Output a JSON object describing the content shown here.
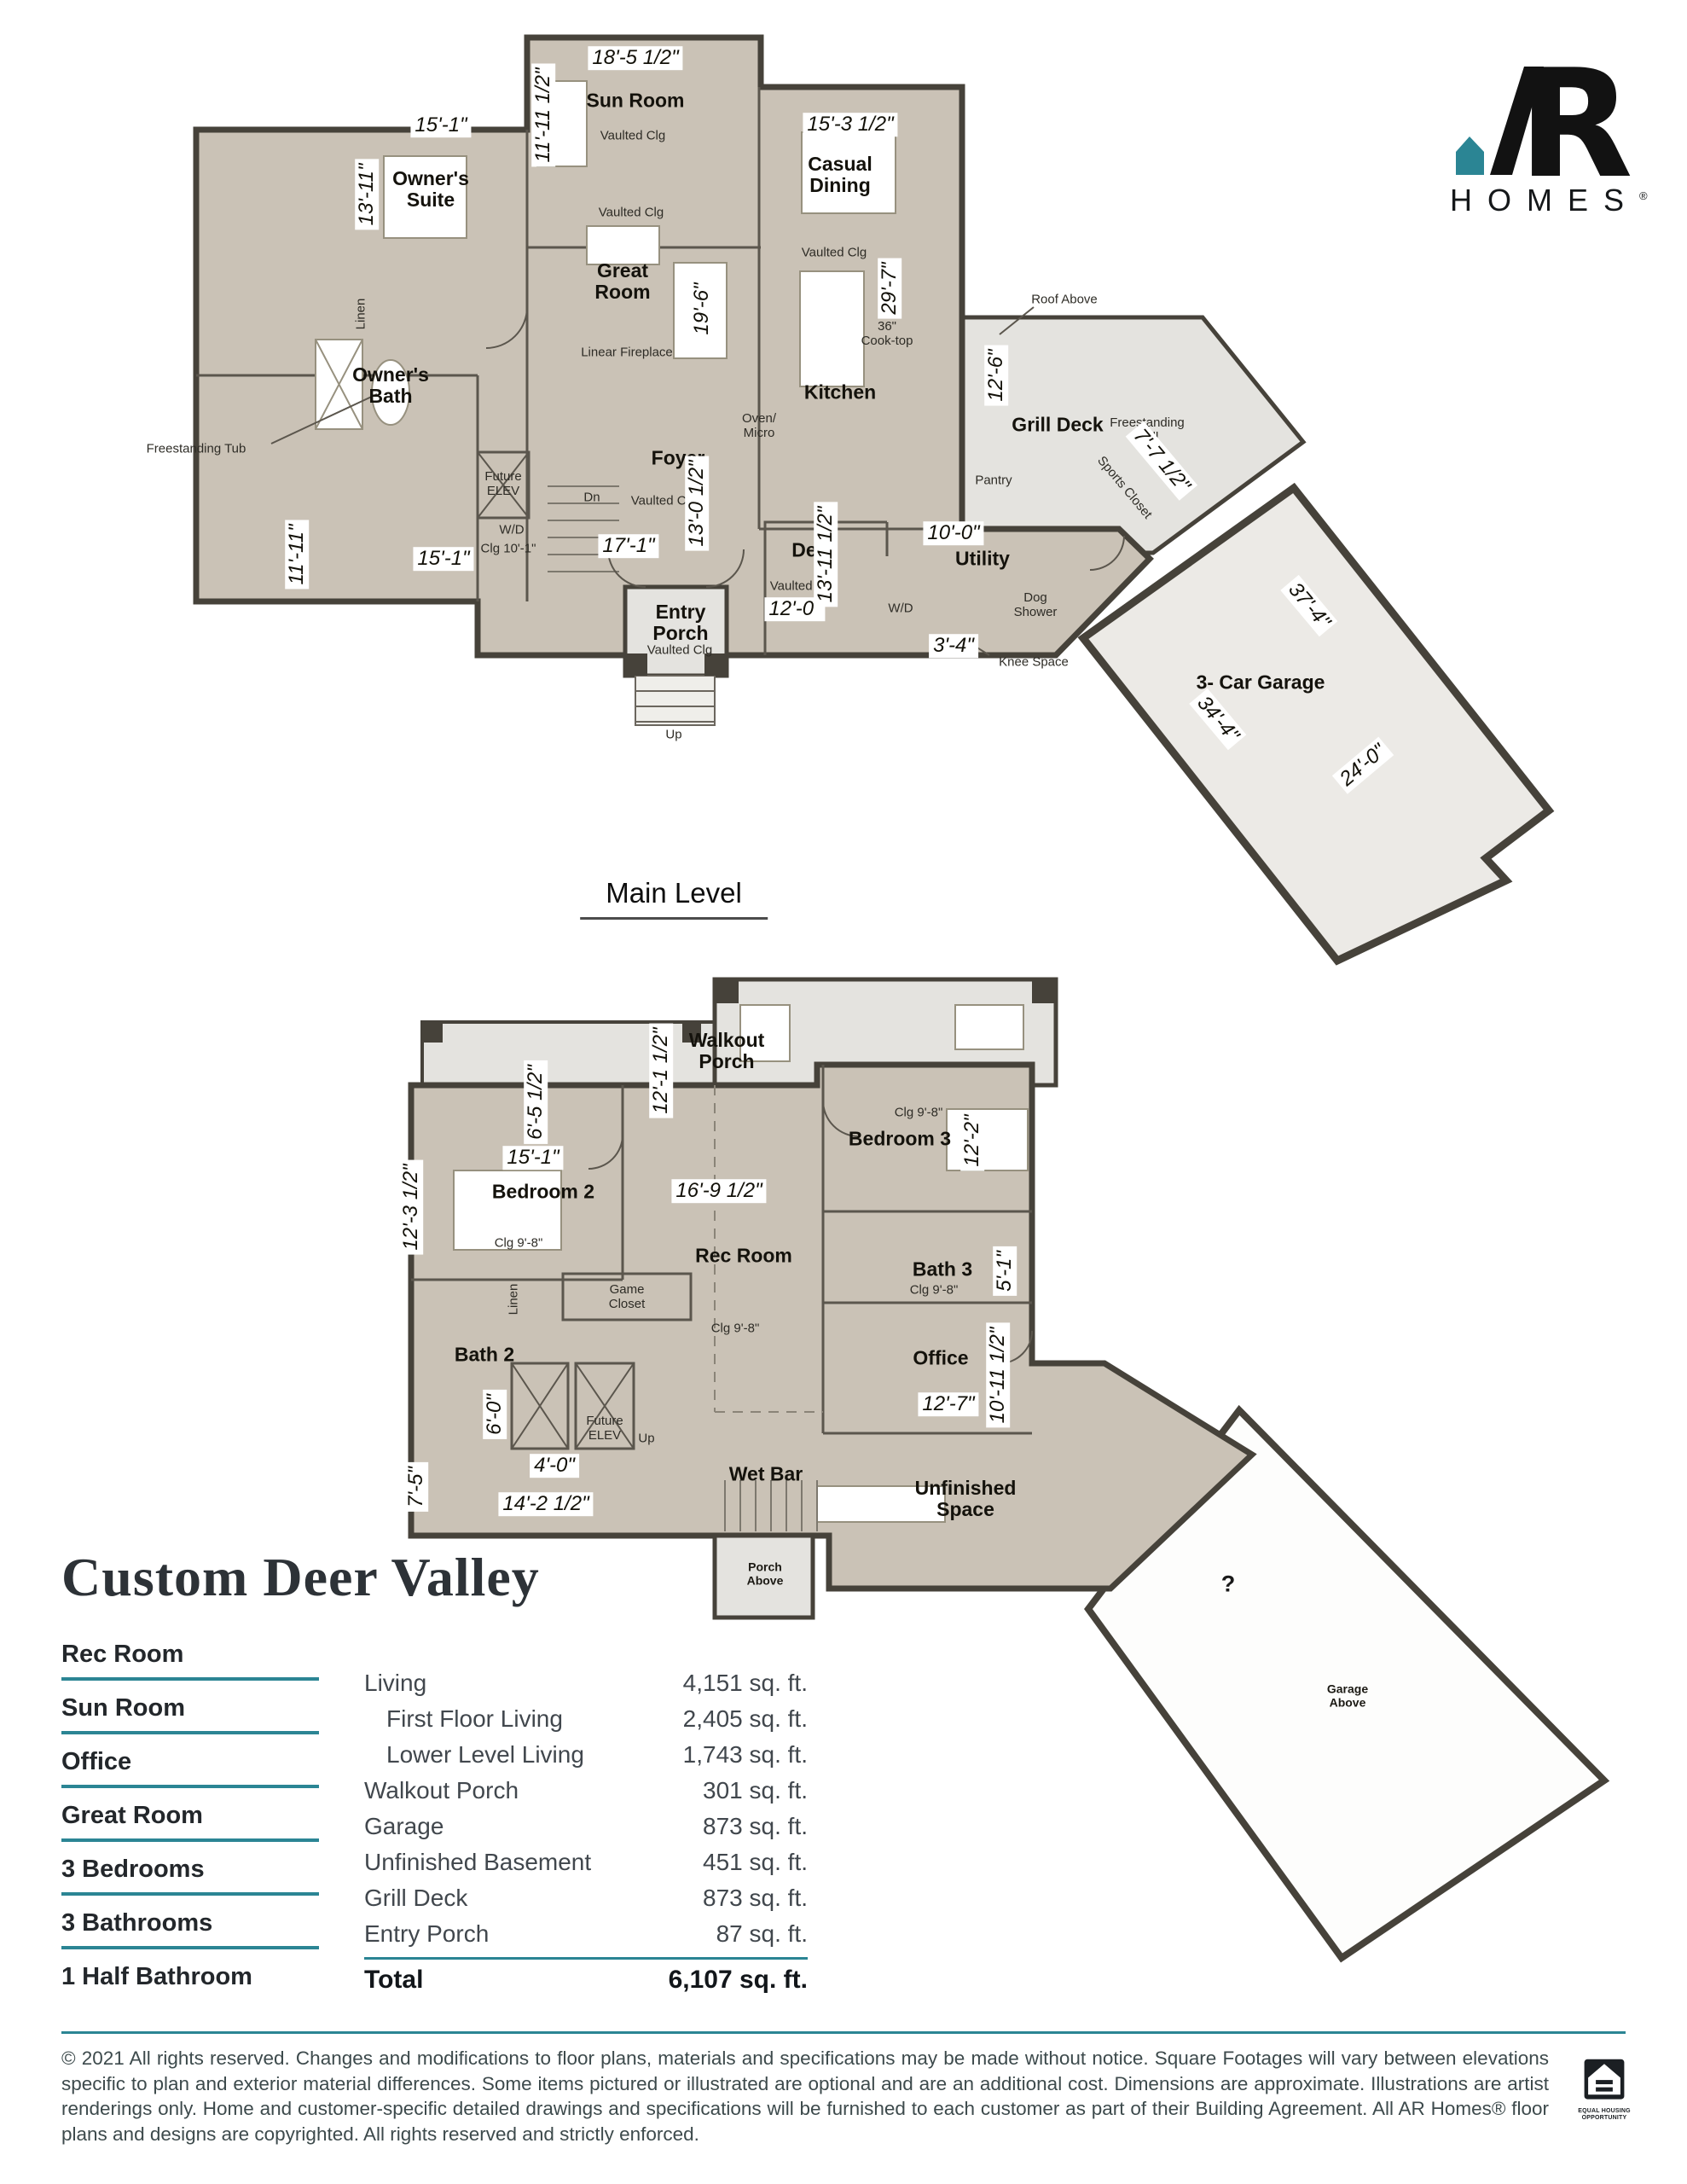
{
  "logo": {
    "monogram": "AR",
    "monogram_r": "R",
    "wordmark": "HOMES",
    "registered": "®"
  },
  "title": "Custom Deer Valley",
  "plan": {
    "main_level": {
      "label": "Main Level",
      "rooms": {
        "sun_room": "Sun Room",
        "owners_suite": "Owner's Suite",
        "casual_dining": "Casual Dining",
        "great_room": "Great Room",
        "kitchen": "Kitchen",
        "owners_bath": "Owner's Bath",
        "foyer": "Foyer",
        "den": "Den",
        "utility": "Utility",
        "grill_deck": "Grill Deck",
        "entry_porch": "Entry Porch",
        "garage": "3- Car Garage"
      },
      "annotations": {
        "vaulted_clg": "Vaulted Clg",
        "linear_fireplace": "Linear Fireplace",
        "cooktop": "36\" Cook-top",
        "oven_micro": "Oven/ Micro",
        "pantry": "Pantry",
        "roof_above": "Roof Above",
        "freestanding_grill": "Freestanding Grill",
        "sports_closet": "Sports Closet",
        "freestanding_tub": "Freestanding Tub",
        "linen": "Linen",
        "wd": "W/D",
        "clg_10_1": "Clg 10'-1\"",
        "dog_shower": "Dog Shower",
        "knee_space": "Knee Space",
        "dn": "Dn",
        "up": "Up",
        "future_elev": "Future ELEV"
      },
      "dims": {
        "d18_5": "18'-5 1/2\"",
        "d11_11_5": "11'-11 1/2\"",
        "d15_1": "15'-1\"",
        "d13_11": "13'-11\"",
        "d15_3_5": "15'-3 1/2\"",
        "d29_7": "29'-7\"",
        "d19_6": "19'-6\"",
        "d13_0_5": "13'-0 1/2\"",
        "d17_1": "17'-1\"",
        "d12_0": "12'-0\"",
        "d13_11_5": "13'-11 1/2\"",
        "d10_0": "10'-0\"",
        "d3_4": "3'-4\"",
        "d12_6": "12'-6\"",
        "d7_7_5": "7'-7 1/2\"",
        "d11_11": "11'-11\"",
        "d37_4": "37'-4\"",
        "d34_4": "34'-4\"",
        "d24_0": "24'-0\""
      }
    },
    "lower_level": {
      "rooms": {
        "walkout_porch": "Walkout Porch",
        "bedroom_2": "Bedroom 2",
        "bedroom_3": "Bedroom 3",
        "rec_room": "Rec Room",
        "bath_2": "Bath 2",
        "bath_3": "Bath 3",
        "office": "Office",
        "wet_bar": "Wet Bar",
        "unfinished_space": "Unfinished Space"
      },
      "annotations": {
        "clg_9_8": "Clg 9'-8\"",
        "linen": "Linen",
        "game_closet": "Game Closet",
        "future_elev": "Future ELEV",
        "up": "Up",
        "porch_above": "Porch Above",
        "garage_above": "Garage Above",
        "unknown_mark": "?"
      },
      "dims": {
        "d12_1_5": "12'-1 1/2\"",
        "d6_5_5": "6'-5 1/2\"",
        "d15_1": "15'-1\"",
        "d12_3_5": "12'-3 1/2\"",
        "d16_9_5": "16'-9 1/2\"",
        "d12_2": "12'-2\"",
        "d5_1": "5'-1\"",
        "d10_11_5": "10'-11 1/2\"",
        "d12_7": "12'-7\"",
        "d6_0": "6'-0\"",
        "d4_0": "4'-0\"",
        "d14_2_5": "14'-2 1/2\"",
        "d7_5": "7'-5\""
      }
    }
  },
  "features": [
    "Rec Room",
    "Sun Room",
    "Office",
    "Great Room",
    "3 Bedrooms",
    "3 Bathrooms",
    "1 Half Bathroom"
  ],
  "area_table": {
    "rows": [
      {
        "label": "Living",
        "value": "4,151 sq. ft.",
        "indent": false
      },
      {
        "label": "First Floor Living",
        "value": "2,405 sq. ft.",
        "indent": true
      },
      {
        "label": "Lower Level Living",
        "value": "1,743 sq. ft.",
        "indent": true
      },
      {
        "label": "Walkout Porch",
        "value": "301 sq. ft.",
        "indent": false
      },
      {
        "label": "Garage",
        "value": "873 sq. ft.",
        "indent": false
      },
      {
        "label": "Unfinished Basement",
        "value": "451 sq. ft.",
        "indent": false
      },
      {
        "label": "Grill Deck",
        "value": "873 sq. ft.",
        "indent": false
      },
      {
        "label": "Entry Porch",
        "value": "87 sq. ft.",
        "indent": false
      }
    ],
    "total": {
      "label": "Total",
      "value": "6,107 sq. ft."
    }
  },
  "footer": {
    "copyright": "© 2021 All rights reserved. Changes and modifications to floor plans, materials and specifications may be made without notice. Square Footages will vary between elevations specific to plan and exterior material differences. Some items pictured or illustrated are optional and are an additional cost. Dimensions are approximate. Illustrations are artist renderings only. Home and customer-specific detailed drawings and specifications will be furnished to each customer as part of their Building Agreement. All AR Homes® floor plans and designs are copyrighted. All rights reserved and strictly enforced.",
    "eho_caption": "EQUAL HOUSING OPPORTUNITY"
  },
  "colors": {
    "accent_teal": "#2b8594",
    "floor": "#cac2b6",
    "deck": "#e4e3df",
    "garage": "#eceae6",
    "wall": "#46423a"
  }
}
